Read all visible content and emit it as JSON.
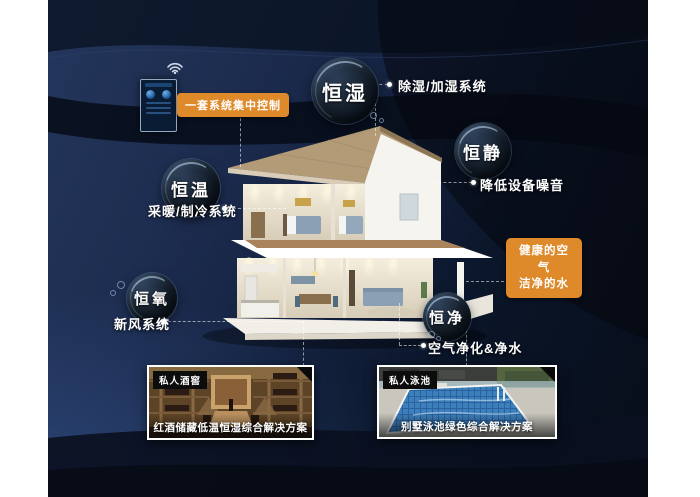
{
  "control_panel": {
    "label": "一套系统集中控制"
  },
  "features": [
    {
      "name": "恒湿",
      "note": "除湿/加湿系统"
    },
    {
      "name": "恒静",
      "note": "降低设备噪音"
    },
    {
      "name": "恒温",
      "note": "采暖/制冷系统"
    },
    {
      "name": "恒氧",
      "note": "新风系统"
    },
    {
      "name": "恒净",
      "note": "空气净化&净水"
    }
  ],
  "highlight_box": {
    "line1": "健康的空气",
    "line2": "洁净的水"
  },
  "cards": [
    {
      "tag": "私人酒窖",
      "caption": "红酒储藏低温恒湿综合解决方案"
    },
    {
      "tag": "私人泳池",
      "caption": "别墅泳池绿色综合解决方案"
    }
  ],
  "colors": {
    "accent": "#de8a2b",
    "background": "#162440",
    "text": "#ffffff"
  }
}
